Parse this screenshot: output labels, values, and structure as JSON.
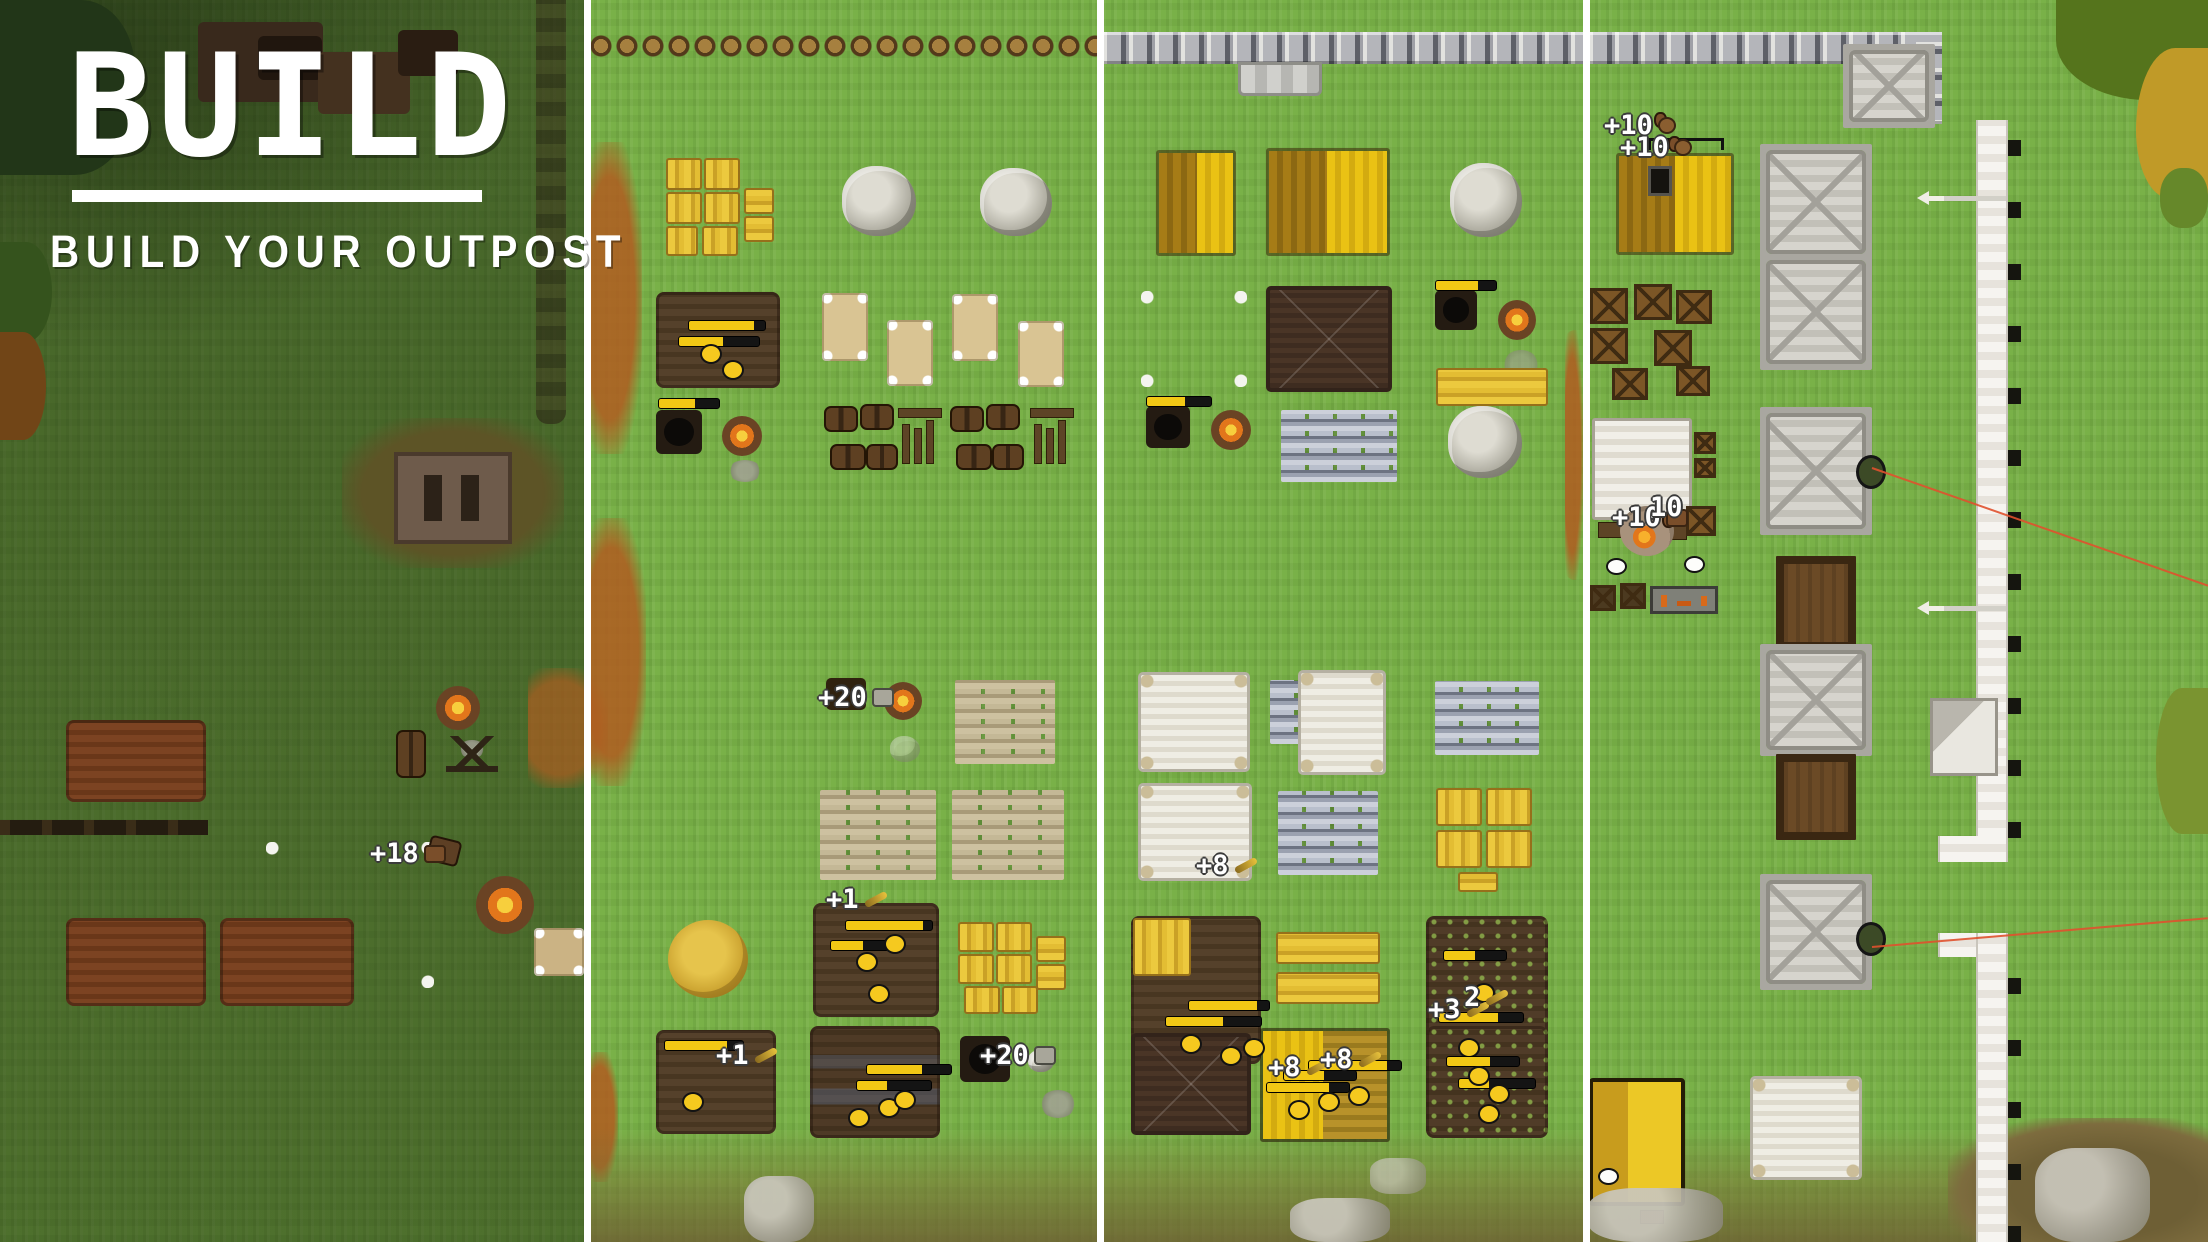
{
  "title": {
    "heading": "BUILD",
    "subtitle": "BUILD YOUR OUTPOST"
  },
  "palette": {
    "grass": "#79b148",
    "panel1_shade": "rgba(22,28,10,0.46)",
    "divider": "#ffffff",
    "hay": "#e3bd33",
    "plot_soil": "#4c3a22",
    "stone": "#b4b5ba",
    "palisade_log": "#a6803f",
    "canvas": "#d9c493",
    "white_canvas": "#eceade",
    "fire_orange": "#e2761b",
    "laser_red": "#e0512d",
    "label_text": "#ffffff"
  },
  "icons": {
    "meat-icon": "brown meat chunk",
    "stone-icon": "gray stone chunk",
    "wheat-icon": "gold wheat sprig",
    "food-icon": "brown loaf"
  },
  "labels": [
    {
      "id": "p1-tent-gain",
      "text": "+18",
      "icon": "meat-icon"
    },
    {
      "id": "p2-quarry-gain",
      "text": "+20",
      "icon": "stone-icon"
    },
    {
      "id": "p2-farm-top-gain",
      "text": "+1",
      "icon": "wheat-icon"
    },
    {
      "id": "p2-farm-left-gain",
      "text": "+1",
      "icon": "wheat-icon"
    },
    {
      "id": "p2-pot-gain",
      "text": "+20",
      "icon": "stone-icon"
    },
    {
      "id": "p3-tent-gain",
      "text": "+8",
      "icon": "wheat-icon"
    },
    {
      "id": "p3-farm-right-a",
      "text": "+3",
      "icon": "wheat-icon"
    },
    {
      "id": "p3-farm-right-b",
      "text": "2",
      "icon": "wheat-icon"
    },
    {
      "id": "p3-farm-mid-a",
      "text": "+8",
      "icon": "wheat-icon"
    },
    {
      "id": "p3-farm-mid-b",
      "text": "+8",
      "icon": "wheat-icon"
    },
    {
      "id": "p4-field-a",
      "text": "+10",
      "icon": "food-icon"
    },
    {
      "id": "p4-field-b",
      "text": "+10",
      "icon": "food-icon"
    },
    {
      "id": "p4-fire-a",
      "text": "+10",
      "icon": "meat-icon"
    },
    {
      "id": "p4-fire-b",
      "text": "10",
      "icon": ""
    }
  ]
}
